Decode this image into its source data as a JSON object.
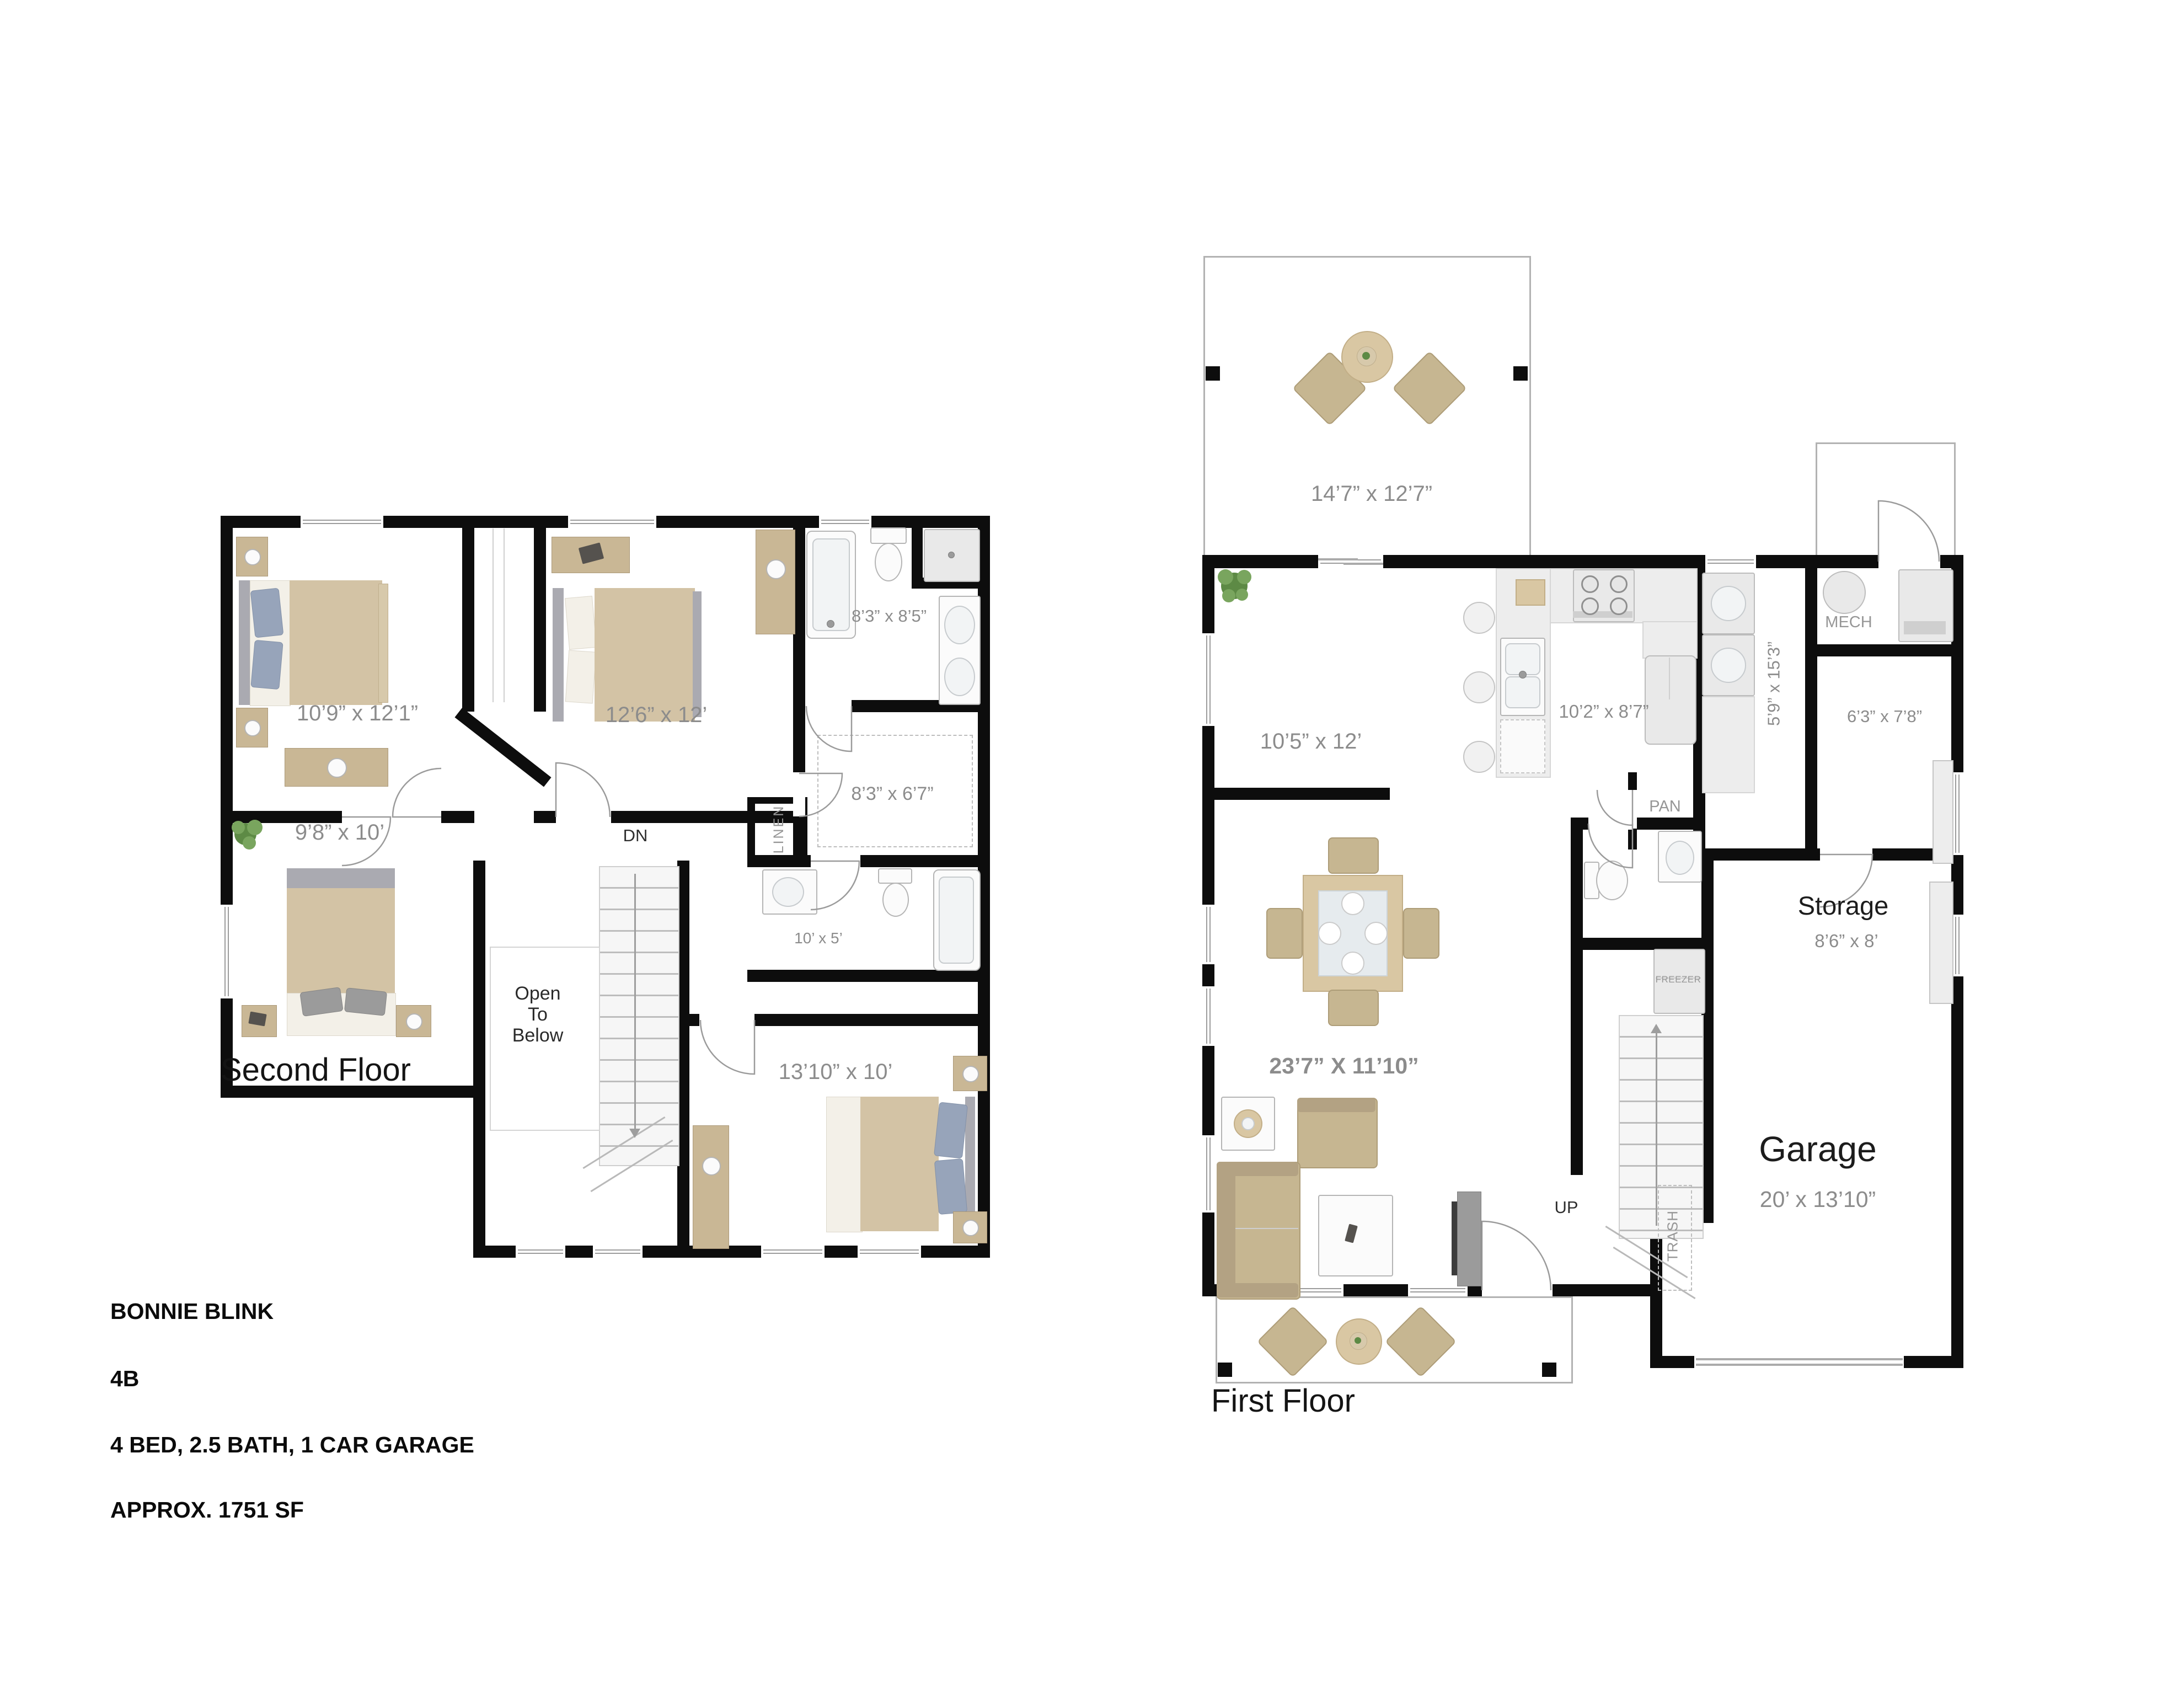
{
  "title_block": {
    "project": "BONNIE BLINK",
    "plan": "4B",
    "specs": "4 BED, 2.5 BATH, 1 CAR GARAGE",
    "area": "APPROX.  1751 SF"
  },
  "second_floor": {
    "floor_label": "Second Floor",
    "rooms": {
      "bedroom1": {
        "dim": "10’9” x 12’1”"
      },
      "bedroom2": {
        "dim": "12’6” x 12’"
      },
      "master_bath": {
        "dim": "8’3” x 8’5”"
      },
      "walkin_closet": {
        "dim": "8’3” x 6’7”"
      },
      "bedroom3": {
        "dim": "9’8” x 10’"
      },
      "hall_bath": {
        "dim": "10’ x 5’"
      },
      "bedroom4": {
        "dim": "13’10” x 10’"
      }
    },
    "annotations": {
      "down": "DN",
      "linen": "LINEN",
      "open_to_below": "Open To Below"
    }
  },
  "first_floor": {
    "floor_label": "First Floor",
    "rooms": {
      "patio": {
        "dim": "14’7” x 12’7”"
      },
      "flex": {
        "dim": "10’5” x 12’"
      },
      "kitchen": {
        "dim": "10’2” x 8’7”"
      },
      "laundry": {
        "dim": "5’9” x 15’3”"
      },
      "entry": {
        "dim": "6’3” x 7’8”"
      },
      "great_room": {
        "dim": "23’7” X 11’10”"
      },
      "storage": {
        "name": "Storage",
        "dim": "8’6” x 8’"
      },
      "garage": {
        "name": "Garage",
        "dim": "20’ x 13’10”"
      }
    },
    "annotations": {
      "pantry": "PAN",
      "mech": "MECH",
      "freezer": "FREEZER",
      "up": "UP",
      "trash": "TRASH"
    }
  }
}
